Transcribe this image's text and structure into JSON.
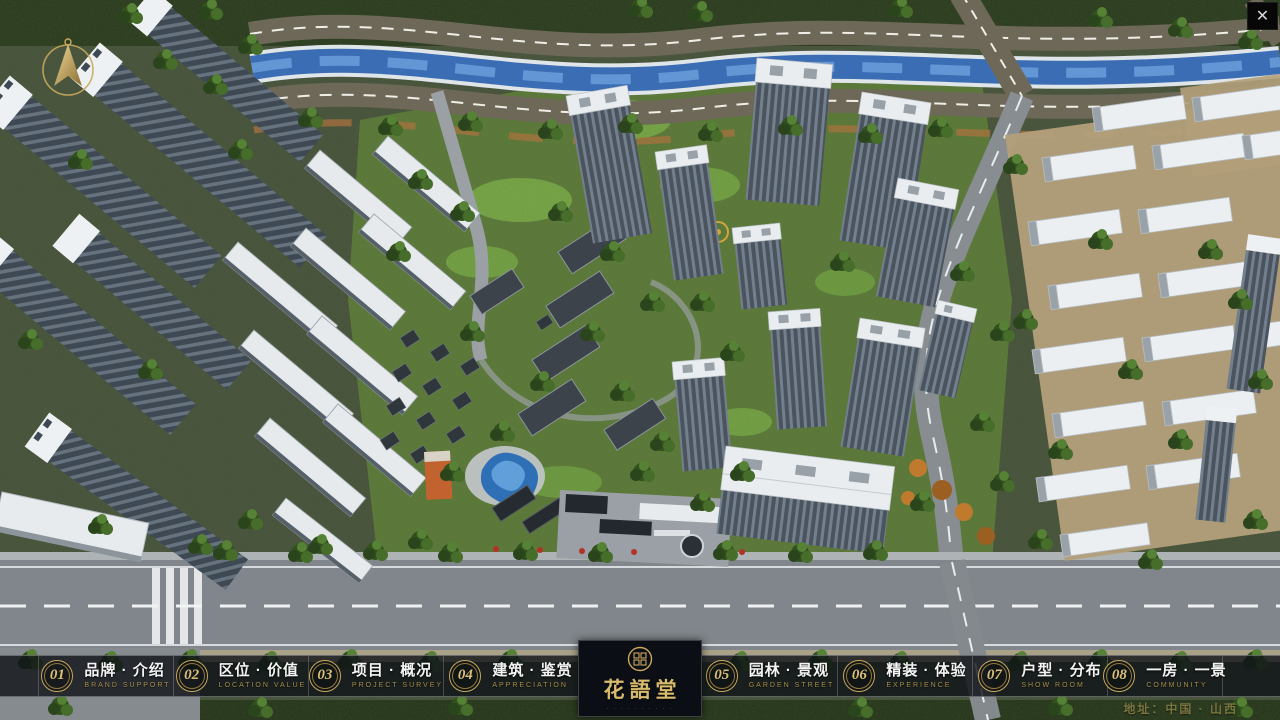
{
  "window": {
    "close_label": "✕"
  },
  "nav": {
    "items": [
      {
        "num": "01",
        "zh": "品牌 · 介绍",
        "en": "BRAND SUPPORT"
      },
      {
        "num": "02",
        "zh": "区位 · 价值",
        "en": "LOCATION VALUE"
      },
      {
        "num": "03",
        "zh": "项目 · 概况",
        "en": "PROJECT SURVEY"
      },
      {
        "num": "04",
        "zh": "建筑 · 鉴赏",
        "en": "APPRECIATION"
      },
      {
        "num": "05",
        "zh": "园林 · 景观",
        "en": "GARDEN STREET"
      },
      {
        "num": "06",
        "zh": "精装 · 体验",
        "en": "EXPERIENCE"
      },
      {
        "num": "07",
        "zh": "户型 · 分布",
        "en": "SHOW ROOM"
      },
      {
        "num": "08",
        "zh": "一房 · 一景",
        "en": "COMMUNITY"
      }
    ]
  },
  "logo": {
    "title": "花語堂",
    "tagline": "· · · · · · · · · ·"
  },
  "footer": {
    "address": "地址：中国 · 山西"
  },
  "colors": {
    "accent_gold": "#c9a85c",
    "bar_bg": "rgba(14,18,22,0.80)",
    "panel_bg": "#0b0f15",
    "water_blue": "#3a6db3",
    "road_gray": "#80868b",
    "tree_green": "#33511f"
  }
}
